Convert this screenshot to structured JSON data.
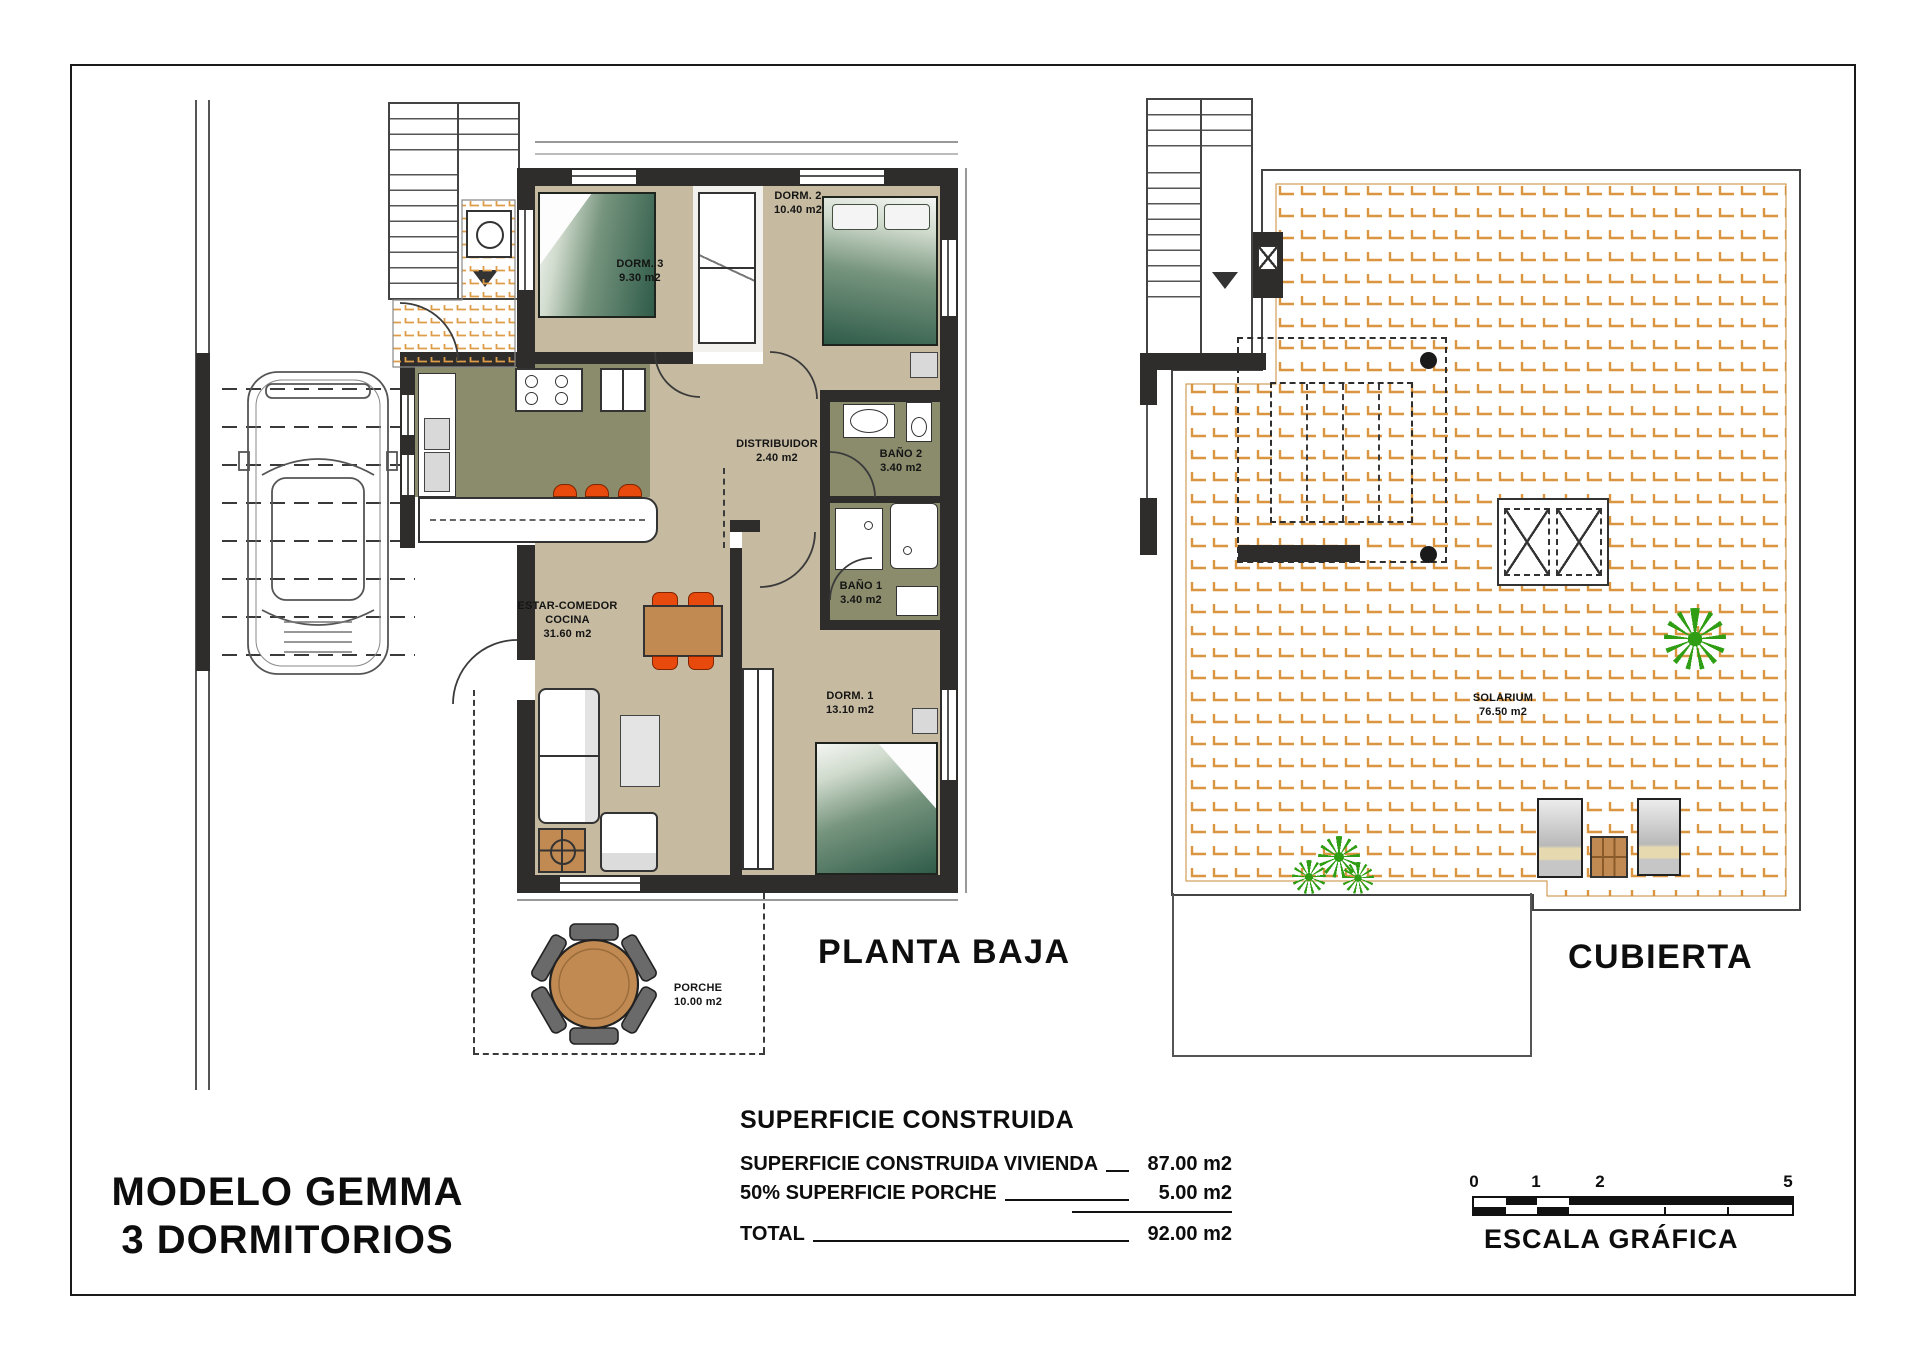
{
  "sheet": {
    "model_line1": "MODELO GEMMA",
    "model_line2": "3 DORMITORIOS"
  },
  "plans": {
    "ground": {
      "title": "PLANTA BAJA"
    },
    "roof": {
      "title": "CUBIERTA"
    }
  },
  "rooms": {
    "dorm1": {
      "name": "DORM. 1",
      "area": "13.10 m2"
    },
    "dorm2": {
      "name": "DORM. 2",
      "area": "10.40 m2"
    },
    "dorm3": {
      "name": "DORM. 3",
      "area": "9.30 m2"
    },
    "distribuidor": {
      "name": "DISTRIBUIDOR",
      "area": "2.40 m2"
    },
    "bano1": {
      "name": "BAÑO 1",
      "area": "3.40 m2"
    },
    "bano2": {
      "name": "BAÑO 2",
      "area": "3.40 m2"
    },
    "estar": {
      "name_line1": "ESTAR-COMEDOR",
      "name_line2": "COCINA",
      "area": "31.60 m2"
    },
    "porche": {
      "name": "PORCHE",
      "area": "10.00 m2"
    },
    "solarium": {
      "name": "SOLARIUM",
      "area": "76.50 m2"
    }
  },
  "surface_table": {
    "title": "SUPERFICIE CONSTRUIDA",
    "rows": [
      {
        "label": "SUPERFICIE CONSTRUIDA VIVIENDA",
        "value": "87.00 m2"
      },
      {
        "label": "50% SUPERFICIE PORCHE",
        "value": "5.00 m2"
      }
    ],
    "total": {
      "label": "TOTAL",
      "value": "92.00 m2"
    }
  },
  "scale_bar": {
    "ticks": [
      "0",
      "1",
      "2",
      "5"
    ],
    "label": "ESCALA GRÁFICA"
  },
  "colors": {
    "floor_beige": "#c6bba1",
    "floor_olive": "#8b8c6c",
    "wall_dark": "#2f2d2b",
    "accent_orange": "#e8490c",
    "tile_orange": "#d9953f",
    "wood_brown": "#c08a52",
    "bed_green": "#2f5c49"
  }
}
